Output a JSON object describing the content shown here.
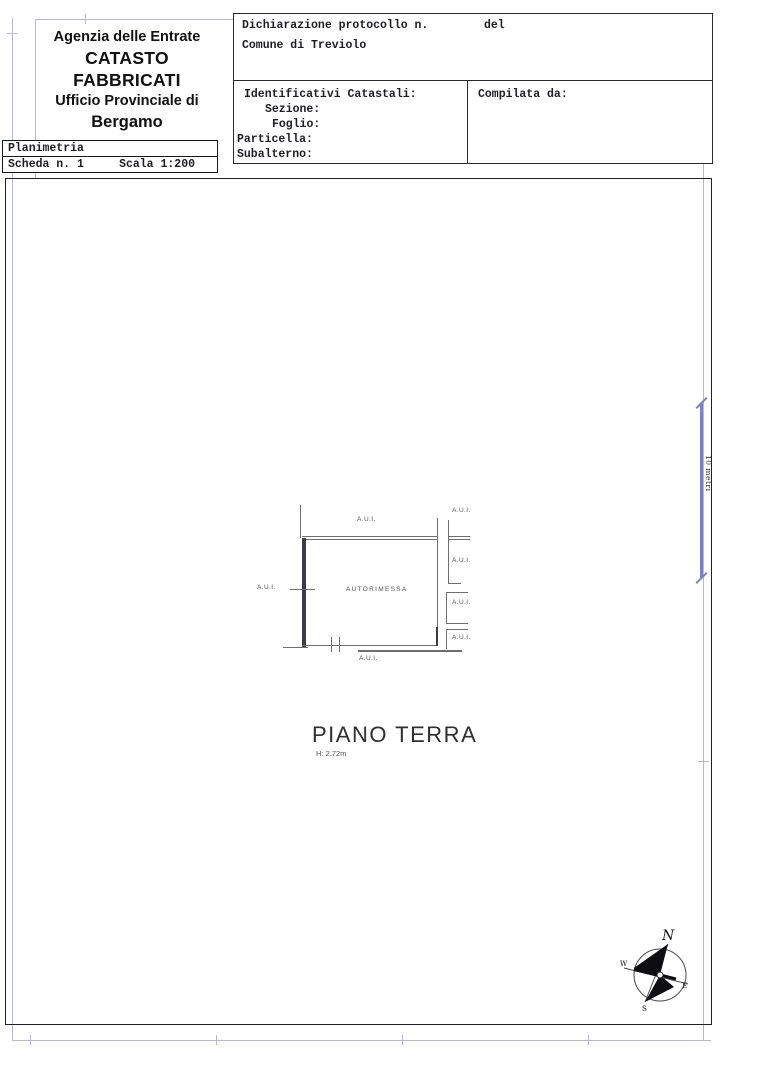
{
  "header": {
    "agency_line1": "Agenzia delle Entrate",
    "agency_line2": "CATASTO FABBRICATI",
    "agency_line3": "Ufficio Provinciale di",
    "agency_line4": "Bergamo",
    "doc_type": "Planimetria",
    "sheet_number": "Scheda n. 1",
    "scale": "Scala 1:200",
    "declaration_label": "Dichiarazione protocollo n.",
    "declaration_del": "del",
    "comune": "Comune di Treviolo",
    "identifiers_title": "Identificativi Catastali:",
    "sezione_label": "Sezione:",
    "foglio_label": "Foglio:",
    "particella_label": "Particella:",
    "subalterno_label": "Subalterno:",
    "compiled_by_label": "Compilata da:"
  },
  "plan": {
    "room_label": "AUTORIMESSA",
    "aui_label": "A.U.I.",
    "floor_title": "PIANO TERRA",
    "floor_height": "H: 2.72m",
    "scale_bar_label": "10 metri"
  },
  "compass": {
    "north": "N",
    "south": "S",
    "east": "E",
    "west": "W"
  },
  "colors": {
    "frame_blue": "#b4b7e2",
    "scale_blue": "#7b82c4",
    "line_dark": "#20202c"
  }
}
